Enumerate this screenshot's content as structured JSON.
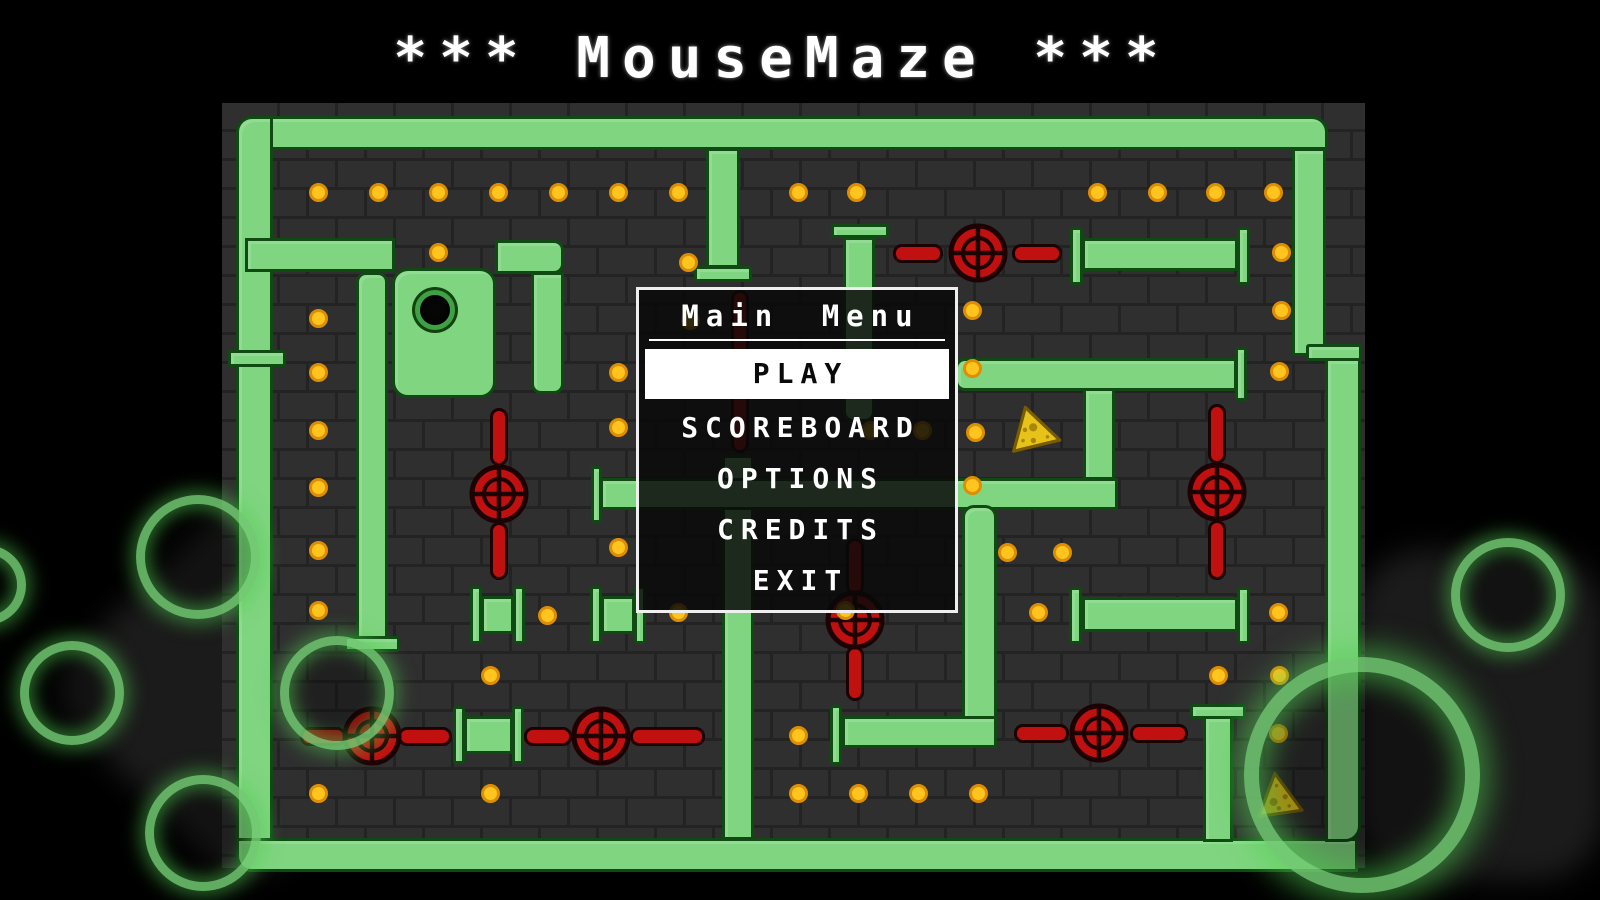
{
  "title": "*** MouseMaze ***",
  "menu": {
    "title": "Main Menu",
    "items": [
      {
        "label": "PLAY",
        "selected": true
      },
      {
        "label": "SCOREBOARD",
        "selected": false
      },
      {
        "label": "OPTIONS",
        "selected": false
      },
      {
        "label": "CREDITS",
        "selected": false
      },
      {
        "label": "EXIT",
        "selected": false
      }
    ]
  },
  "colors": {
    "background": "#000000",
    "brick": "#2f2f2f",
    "mortar": "#232323",
    "pipe_green": "#80d580",
    "pipe_outline": "#0e4a12",
    "dot_yellow": "#ffc41d",
    "dot_outline": "#dd8e04",
    "valve_red": "#c11010",
    "valve_outline": "#1c0202",
    "cheese_yellow": "#e7c319",
    "cheese_outline": "#7a5c00",
    "glow_green": "#78d778",
    "menu_border": "#efefef",
    "selected_bg": "#ffffff",
    "text": "#ffffff"
  },
  "maze": {
    "panel": {
      "x": 222,
      "y": 103,
      "w": 1143,
      "h": 765
    },
    "pipes": [
      [
        236,
        116,
        1092,
        34,
        "16px 16px 0 0"
      ],
      [
        236,
        116,
        37,
        744,
        "16px 0 0 16px"
      ],
      [
        236,
        838,
        1122,
        34,
        "0 0 0 16px"
      ],
      [
        1292,
        148,
        34,
        208,
        ""
      ],
      [
        1306,
        344,
        56,
        17,
        "3px"
      ],
      [
        1325,
        358,
        36,
        484,
        "0 0 16px 0"
      ],
      [
        228,
        350,
        58,
        17,
        "3px"
      ],
      [
        245,
        238,
        150,
        34,
        ""
      ],
      [
        392,
        268,
        104,
        130,
        "16px"
      ],
      [
        495,
        240,
        69,
        34,
        "0 10px 10px 0"
      ],
      [
        531,
        272,
        33,
        122,
        "0 0 10px 10px"
      ],
      [
        356,
        272,
        32,
        368,
        "10px 10px 0 0"
      ],
      [
        344,
        636,
        56,
        16,
        "3px"
      ],
      [
        706,
        148,
        34,
        120,
        ""
      ],
      [
        694,
        266,
        58,
        16,
        "3px"
      ],
      [
        722,
        455,
        32,
        385,
        ""
      ],
      [
        600,
        478,
        518,
        32,
        ""
      ],
      [
        591,
        466,
        11,
        57,
        "3px"
      ],
      [
        843,
        237,
        32,
        185,
        "0 0 10px 10px"
      ],
      [
        831,
        224,
        58,
        14,
        "3px"
      ],
      [
        1082,
        238,
        156,
        33,
        ""
      ],
      [
        1070,
        227,
        13,
        58,
        "3px"
      ],
      [
        1237,
        227,
        13,
        58,
        "3px"
      ],
      [
        955,
        358,
        282,
        33,
        "10px 0 0 10px"
      ],
      [
        1235,
        347,
        12,
        54,
        "3px"
      ],
      [
        1083,
        388,
        32,
        92,
        ""
      ],
      [
        1082,
        597,
        156,
        35,
        ""
      ],
      [
        1069,
        587,
        13,
        57,
        "3px"
      ],
      [
        1237,
        587,
        13,
        57,
        "3px"
      ],
      [
        1203,
        716,
        30,
        126,
        ""
      ],
      [
        1190,
        704,
        56,
        15,
        "3px"
      ],
      [
        962,
        505,
        35,
        243,
        "12px 12px 12px 0"
      ],
      [
        842,
        716,
        155,
        32,
        ""
      ],
      [
        830,
        705,
        12,
        60,
        "3px"
      ],
      [
        453,
        706,
        12,
        58,
        "3px"
      ],
      [
        512,
        706,
        12,
        58,
        "3px"
      ],
      [
        464,
        716,
        49,
        38,
        ""
      ],
      [
        470,
        586,
        12,
        58,
        "3px"
      ],
      [
        513,
        586,
        12,
        58,
        "3px"
      ],
      [
        481,
        596,
        33,
        38,
        ""
      ],
      [
        590,
        586,
        12,
        58,
        "3px"
      ],
      [
        634,
        586,
        12,
        58,
        "3px"
      ],
      [
        601,
        596,
        34,
        38,
        ""
      ]
    ],
    "red_pipes": [
      [
        893,
        244,
        50,
        19
      ],
      [
        1012,
        244,
        50,
        19
      ],
      [
        731,
        290,
        18,
        163
      ],
      [
        490,
        408,
        18,
        58
      ],
      [
        490,
        522,
        18,
        58
      ],
      [
        1208,
        404,
        18,
        60
      ],
      [
        1208,
        520,
        18,
        60
      ],
      [
        846,
        538,
        18,
        57
      ],
      [
        846,
        646,
        18,
        55
      ],
      [
        300,
        727,
        46,
        19
      ],
      [
        398,
        727,
        54,
        19
      ],
      [
        524,
        727,
        48,
        19
      ],
      [
        630,
        727,
        75,
        19
      ],
      [
        1014,
        724,
        55,
        19
      ],
      [
        1130,
        724,
        58,
        19
      ]
    ],
    "valves": [
      [
        978,
        253
      ],
      [
        499,
        494
      ],
      [
        1217,
        492
      ],
      [
        855,
        620
      ],
      [
        372,
        736
      ],
      [
        601,
        736
      ],
      [
        1099,
        733
      ]
    ],
    "dots": [
      [
        318,
        192
      ],
      [
        378,
        192
      ],
      [
        438,
        192
      ],
      [
        498,
        192
      ],
      [
        558,
        192
      ],
      [
        618,
        192
      ],
      [
        678,
        192
      ],
      [
        798,
        192
      ],
      [
        856,
        192
      ],
      [
        1097,
        192
      ],
      [
        1157,
        192
      ],
      [
        1215,
        192
      ],
      [
        1273,
        192
      ],
      [
        438,
        252
      ],
      [
        688,
        262
      ],
      [
        1281,
        252
      ],
      [
        318,
        318
      ],
      [
        690,
        320
      ],
      [
        972,
        310
      ],
      [
        1281,
        310
      ],
      [
        318,
        372
      ],
      [
        618,
        372
      ],
      [
        972,
        368
      ],
      [
        1279,
        371
      ],
      [
        318,
        430
      ],
      [
        618,
        427
      ],
      [
        975,
        432
      ],
      [
        870,
        430
      ],
      [
        922,
        430
      ],
      [
        318,
        487
      ],
      [
        972,
        485
      ],
      [
        318,
        550
      ],
      [
        618,
        547
      ],
      [
        1007,
        552
      ],
      [
        1062,
        552
      ],
      [
        318,
        610
      ],
      [
        547,
        615
      ],
      [
        678,
        612
      ],
      [
        845,
        610
      ],
      [
        1038,
        612
      ],
      [
        1278,
        612
      ],
      [
        490,
        675
      ],
      [
        1218,
        675
      ],
      [
        1279,
        675
      ],
      [
        798,
        735
      ],
      [
        1278,
        733
      ],
      [
        318,
        793
      ],
      [
        490,
        793
      ],
      [
        798,
        793
      ],
      [
        858,
        793
      ],
      [
        918,
        793
      ],
      [
        978,
        793
      ]
    ],
    "hole": {
      "x": 440,
      "y": 315,
      "r": 25
    },
    "cheeses": [
      {
        "x": 1037,
        "y": 434,
        "s": 58,
        "rot": 105
      },
      {
        "x": 1278,
        "y": 796,
        "s": 56,
        "rot": -8
      }
    ],
    "rings": [
      {
        "x": 198,
        "y": 557,
        "r": 62,
        "thick": false
      },
      {
        "x": 72,
        "y": 693,
        "r": 52,
        "thick": false
      },
      {
        "x": 203,
        "y": 833,
        "r": 58,
        "thick": false
      },
      {
        "x": 337,
        "y": 693,
        "r": 57,
        "thick": false
      },
      {
        "x": -14,
        "y": 585,
        "r": 40,
        "thick": false
      },
      {
        "x": 1508,
        "y": 595,
        "r": 57,
        "thick": false
      },
      {
        "x": 1362,
        "y": 775,
        "r": 118,
        "thick": true
      }
    ],
    "blobs": [
      {
        "x": 245,
        "y": 690,
        "w": 290,
        "h": 290,
        "rot": 45,
        "rad": 48
      },
      {
        "x": 1480,
        "y": 715,
        "w": 250,
        "h": 330,
        "rot": 0,
        "rad": 70
      }
    ]
  }
}
